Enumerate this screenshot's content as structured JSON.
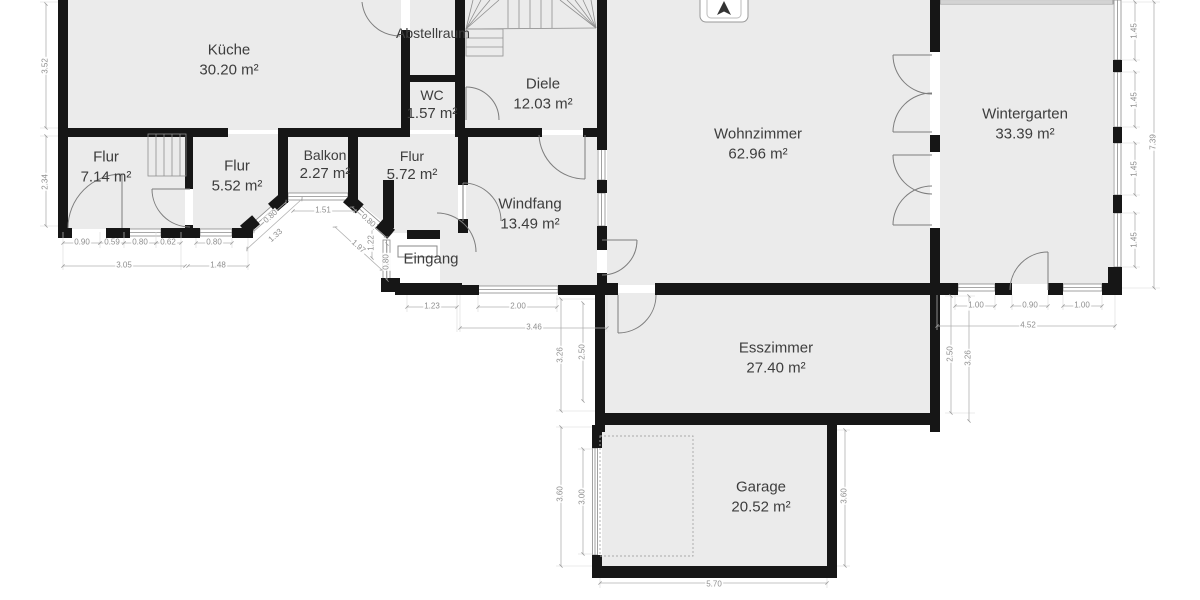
{
  "plan": {
    "colors": {
      "background": "#ffffff",
      "room_fill": "#ebebeb",
      "wall": "#161616",
      "dimension_text": "#8f8f8f",
      "label_text": "#3d3d3d"
    },
    "compass": "north-arrow"
  },
  "rooms": [
    {
      "id": "kueche",
      "name": "Küche",
      "area": "30.20 m²",
      "x": 229,
      "y": 60
    },
    {
      "id": "abstellraum",
      "name": "Abstellraum",
      "area": "",
      "x": 433,
      "y": 33,
      "small": true
    },
    {
      "id": "wc",
      "name": "WC",
      "area": "1.57 m²",
      "x": 432,
      "y": 105,
      "small": true
    },
    {
      "id": "diele",
      "name": "Diele",
      "area": "12.03 m²",
      "x": 543,
      "y": 94
    },
    {
      "id": "wohnzimmer",
      "name": "Wohnzimmer",
      "area": "62.96 m²",
      "x": 758,
      "y": 144
    },
    {
      "id": "wintergarten",
      "name": "Wintergarten",
      "area": "33.39 m²",
      "x": 1025,
      "y": 124
    },
    {
      "id": "flur-1",
      "name": "Flur",
      "area": "7.14 m²",
      "x": 106,
      "y": 167
    },
    {
      "id": "flur-2",
      "name": "Flur",
      "area": "5.52 m²",
      "x": 237,
      "y": 176
    },
    {
      "id": "balkon",
      "name": "Balkon",
      "area": "2.27 m²",
      "x": 325,
      "y": 165,
      "small": true
    },
    {
      "id": "flur-3",
      "name": "Flur",
      "area": "5.72 m²",
      "x": 412,
      "y": 166,
      "small": true
    },
    {
      "id": "windfang",
      "name": "Windfang",
      "area": "13.49 m²",
      "x": 530,
      "y": 214
    },
    {
      "id": "eingang",
      "name": "Eingang",
      "area": "",
      "x": 431,
      "y": 259
    },
    {
      "id": "esszimmer",
      "name": "Esszimmer",
      "area": "27.40 m²",
      "x": 776,
      "y": 358
    },
    {
      "id": "garage",
      "name": "Garage",
      "area": "20.52 m²",
      "x": 761,
      "y": 497
    }
  ],
  "dimensions": [
    {
      "t": "3.52",
      "x": 46,
      "y": 66,
      "r": -90
    },
    {
      "t": "2.34",
      "x": 46,
      "y": 182,
      "r": -90
    },
    {
      "t": "0.90",
      "x": 82,
      "y": 243,
      "r": 0
    },
    {
      "t": "0.59",
      "x": 112,
      "y": 243,
      "r": 0
    },
    {
      "t": "0.80",
      "x": 140,
      "y": 243,
      "r": 0
    },
    {
      "t": "0.62",
      "x": 168,
      "y": 243,
      "r": 0
    },
    {
      "t": "0.80",
      "x": 214,
      "y": 243,
      "r": 0
    },
    {
      "t": "3.05",
      "x": 124,
      "y": 266,
      "r": 0
    },
    {
      "t": "1.48",
      "x": 218,
      "y": 266,
      "r": 0
    },
    {
      "t": "0.80",
      "x": 271,
      "y": 217,
      "r": -42
    },
    {
      "t": "1.33",
      "x": 276,
      "y": 236,
      "r": -42
    },
    {
      "t": "1.51",
      "x": 323,
      "y": 211,
      "r": 0
    },
    {
      "t": "0.80",
      "x": 368,
      "y": 221,
      "r": 42
    },
    {
      "t": "1.97",
      "x": 358,
      "y": 247,
      "r": 42
    },
    {
      "t": "1.22",
      "x": 372,
      "y": 243,
      "r": -90
    },
    {
      "t": "0.80",
      "x": 387,
      "y": 262,
      "r": -90
    },
    {
      "t": "1.23",
      "x": 432,
      "y": 307,
      "r": 0
    },
    {
      "t": "2.00",
      "x": 518,
      "y": 307,
      "r": 0
    },
    {
      "t": "3.46",
      "x": 534,
      "y": 328,
      "r": 0
    },
    {
      "t": "3.26",
      "x": 561,
      "y": 355,
      "r": -90
    },
    {
      "t": "2.50",
      "x": 583,
      "y": 352,
      "r": -90
    },
    {
      "t": "2.50",
      "x": 951,
      "y": 354,
      "r": -90
    },
    {
      "t": "3.26",
      "x": 969,
      "y": 358,
      "r": -90
    },
    {
      "t": "1.00",
      "x": 976,
      "y": 306,
      "r": 0
    },
    {
      "t": "0.90",
      "x": 1030,
      "y": 306,
      "r": 0
    },
    {
      "t": "1.00",
      "x": 1082,
      "y": 306,
      "r": 0
    },
    {
      "t": "4.52",
      "x": 1028,
      "y": 326,
      "r": 0
    },
    {
      "t": "1.45",
      "x": 1135,
      "y": 31,
      "r": -90
    },
    {
      "t": "1.45",
      "x": 1135,
      "y": 100,
      "r": -90
    },
    {
      "t": "1.45",
      "x": 1135,
      "y": 169,
      "r": -90
    },
    {
      "t": "1.45",
      "x": 1135,
      "y": 240,
      "r": -90
    },
    {
      "t": "7.39",
      "x": 1154,
      "y": 142,
      "r": -90
    },
    {
      "t": "3.60",
      "x": 561,
      "y": 494,
      "r": -90
    },
    {
      "t": "3.00",
      "x": 583,
      "y": 497,
      "r": -90
    },
    {
      "t": "3.60",
      "x": 845,
      "y": 496,
      "r": -90
    },
    {
      "t": "5.70",
      "x": 714,
      "y": 585,
      "r": 0
    }
  ]
}
